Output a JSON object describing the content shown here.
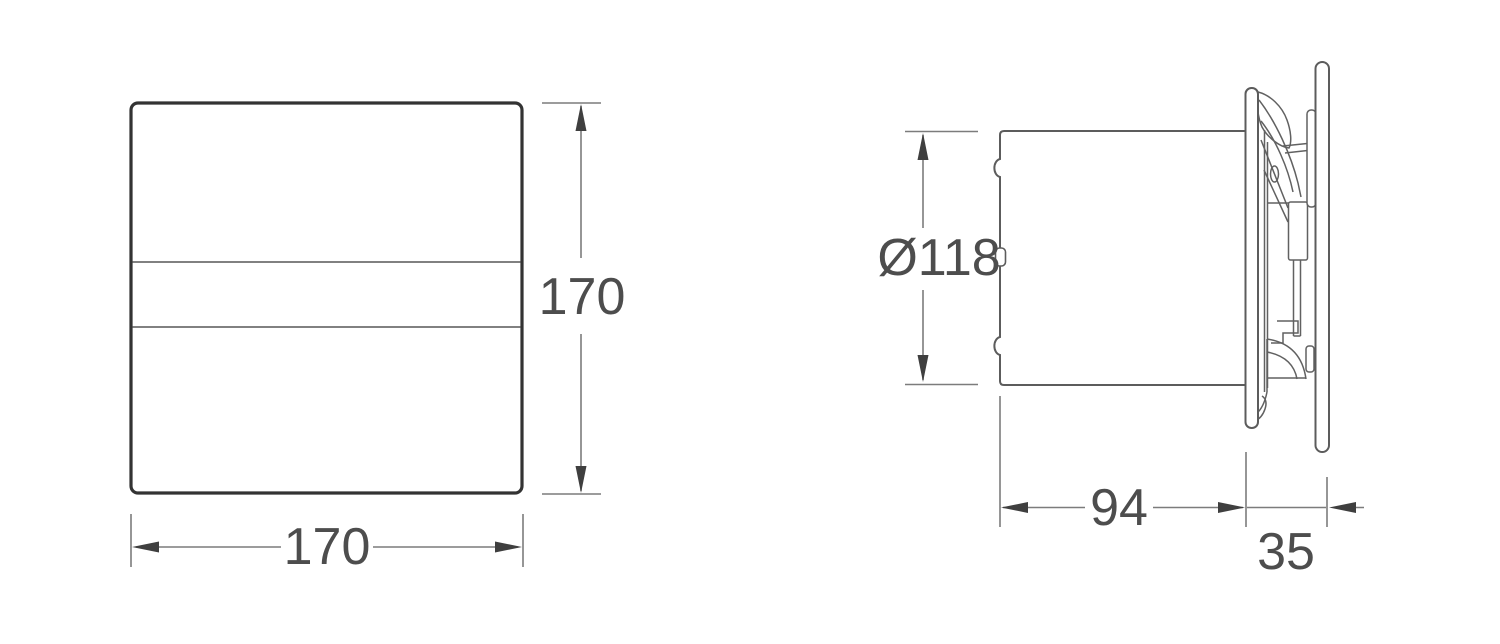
{
  "drawing": {
    "front_view": {
      "height_dim": "170",
      "width_dim": "170"
    },
    "side_view": {
      "diameter_dim": "Ø118",
      "body_depth_dim": "94",
      "cover_depth_dim": "35"
    },
    "colors": {
      "background": "#ffffff",
      "outline_dark": "#333333",
      "line_gray": "#5c5c5c",
      "dimension_gray": "#7c7c7c",
      "arrow_dark": "#3f3f3f",
      "text_gray": "#4d4d4d"
    }
  }
}
